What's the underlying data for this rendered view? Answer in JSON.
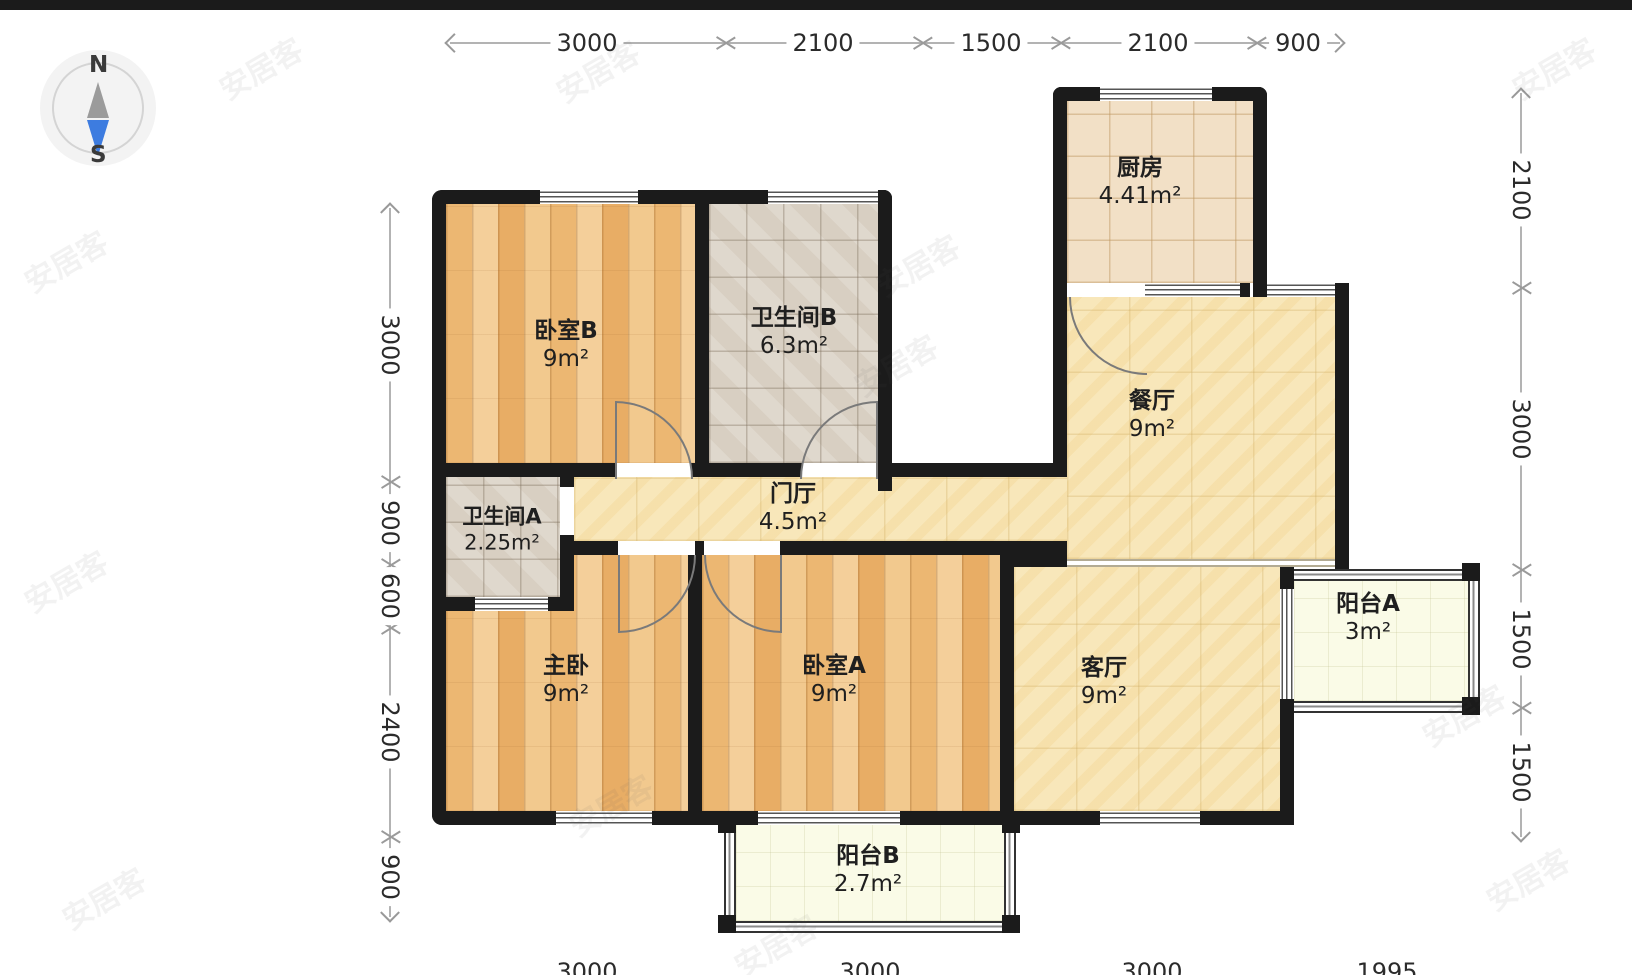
{
  "compass": {
    "north": "N",
    "south": "S"
  },
  "rooms": {
    "bedroom_b": {
      "name": "卧室B",
      "area": "9m²"
    },
    "bath_b": {
      "name": "卫生间B",
      "area": "6.3m²"
    },
    "kitchen": {
      "name": "厨房",
      "area": "4.41m²"
    },
    "dining": {
      "name": "餐厅",
      "area": "9m²"
    },
    "hall": {
      "name": "门厅",
      "area": "4.5m²"
    },
    "bath_a": {
      "name": "卫生间A",
      "area": "2.25m²"
    },
    "master": {
      "name": "主卧",
      "area": "9m²"
    },
    "bedroom_a": {
      "name": "卧室A",
      "area": "9m²"
    },
    "living": {
      "name": "客厅",
      "area": "9m²"
    },
    "balcony_a": {
      "name": "阳台A",
      "area": "3m²"
    },
    "balcony_b": {
      "name": "阳台B",
      "area": "2.7m²"
    }
  },
  "dimensions": {
    "top": [
      "3000",
      "2100",
      "1500",
      "2100",
      "900"
    ],
    "left": [
      "3000",
      "900",
      "600",
      "2400",
      "900"
    ],
    "right": [
      "2100",
      "3000",
      "1500",
      "1500"
    ],
    "bottom": [
      "3000",
      "3000",
      "3000",
      "1995"
    ]
  },
  "watermark": "安居客",
  "colors": {
    "wall": "#1b1b1b",
    "wood_floor": "#eebd7c",
    "tile_yellow": "#f8e7ba",
    "tile_gray": "#d8cfc2",
    "tile_warm": "#f2e0c6",
    "balcony": "#fafbe7",
    "south_needle": "#3d7ce0",
    "north_needle": "#9b9b9b"
  }
}
